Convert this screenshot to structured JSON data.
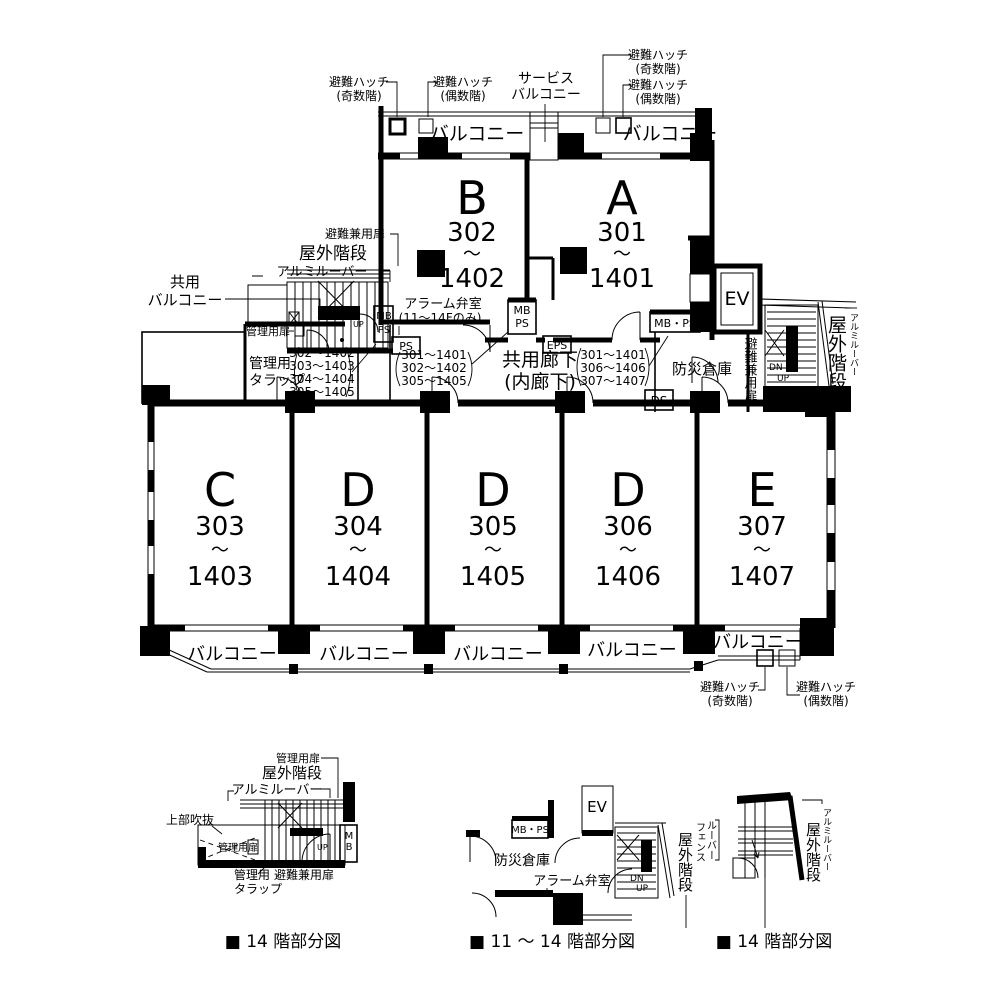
{
  "colors": {
    "ink": "#000000",
    "paper": "#ffffff"
  },
  "common": {
    "balcony": "バルコニー",
    "service1": "サービス",
    "shared1": "共用",
    "hatch": "避難ハッチ",
    "odd": "(奇数階)",
    "even": "(偶数階)",
    "outdoor_stair": "屋外階段",
    "aluminum_louver": "アルミルーバー",
    "escape_door": "避難兼用扉",
    "admin_door": "管理用扉",
    "admin1": "管理用",
    "admin2": "タラップ",
    "alarm_room": "アラーム弁室",
    "alarm_floors": "(11～14Fのみ)",
    "disaster_store": "防災倉庫",
    "corridor1": "共用廊下",
    "corridor2": "(内廊下)",
    "void_above": "上部吹抜",
    "louver1": "ルーバー",
    "louver2": "フェンス",
    "ev": "EV",
    "mb": "MB",
    "ps": "PS",
    "mbps": "MB・PS",
    "eps": "EPS",
    "ds": "DS",
    "dn": "DN",
    "up": "UP"
  },
  "units": {
    "upper": [
      {
        "letter": "B",
        "from": "302",
        "tilde": "～",
        "to": "1402"
      },
      {
        "letter": "A",
        "from": "301",
        "tilde": "～",
        "to": "1401"
      }
    ],
    "lower": [
      {
        "letter": "C",
        "from": "303",
        "tilde": "～",
        "to": "1403"
      },
      {
        "letter": "D",
        "from": "304",
        "tilde": "～",
        "to": "1404"
      },
      {
        "letter": "D",
        "from": "305",
        "tilde": "～",
        "to": "1405"
      },
      {
        "letter": "D",
        "from": "306",
        "tilde": "～",
        "to": "1406"
      },
      {
        "letter": "E",
        "from": "307",
        "tilde": "～",
        "to": "1407"
      }
    ]
  },
  "lists": {
    "left": [
      "302～1402",
      "303～1403",
      "304～1404",
      "305～1405"
    ],
    "mid": [
      "301～1401",
      "302～1402",
      "305～1405"
    ],
    "right": [
      "301～1401",
      "306～1406",
      "307～1407"
    ]
  },
  "captions": [
    "■ 14 階部分図",
    "■ 11 ～ 14 階部分図",
    "■ 14 階部分図"
  ]
}
